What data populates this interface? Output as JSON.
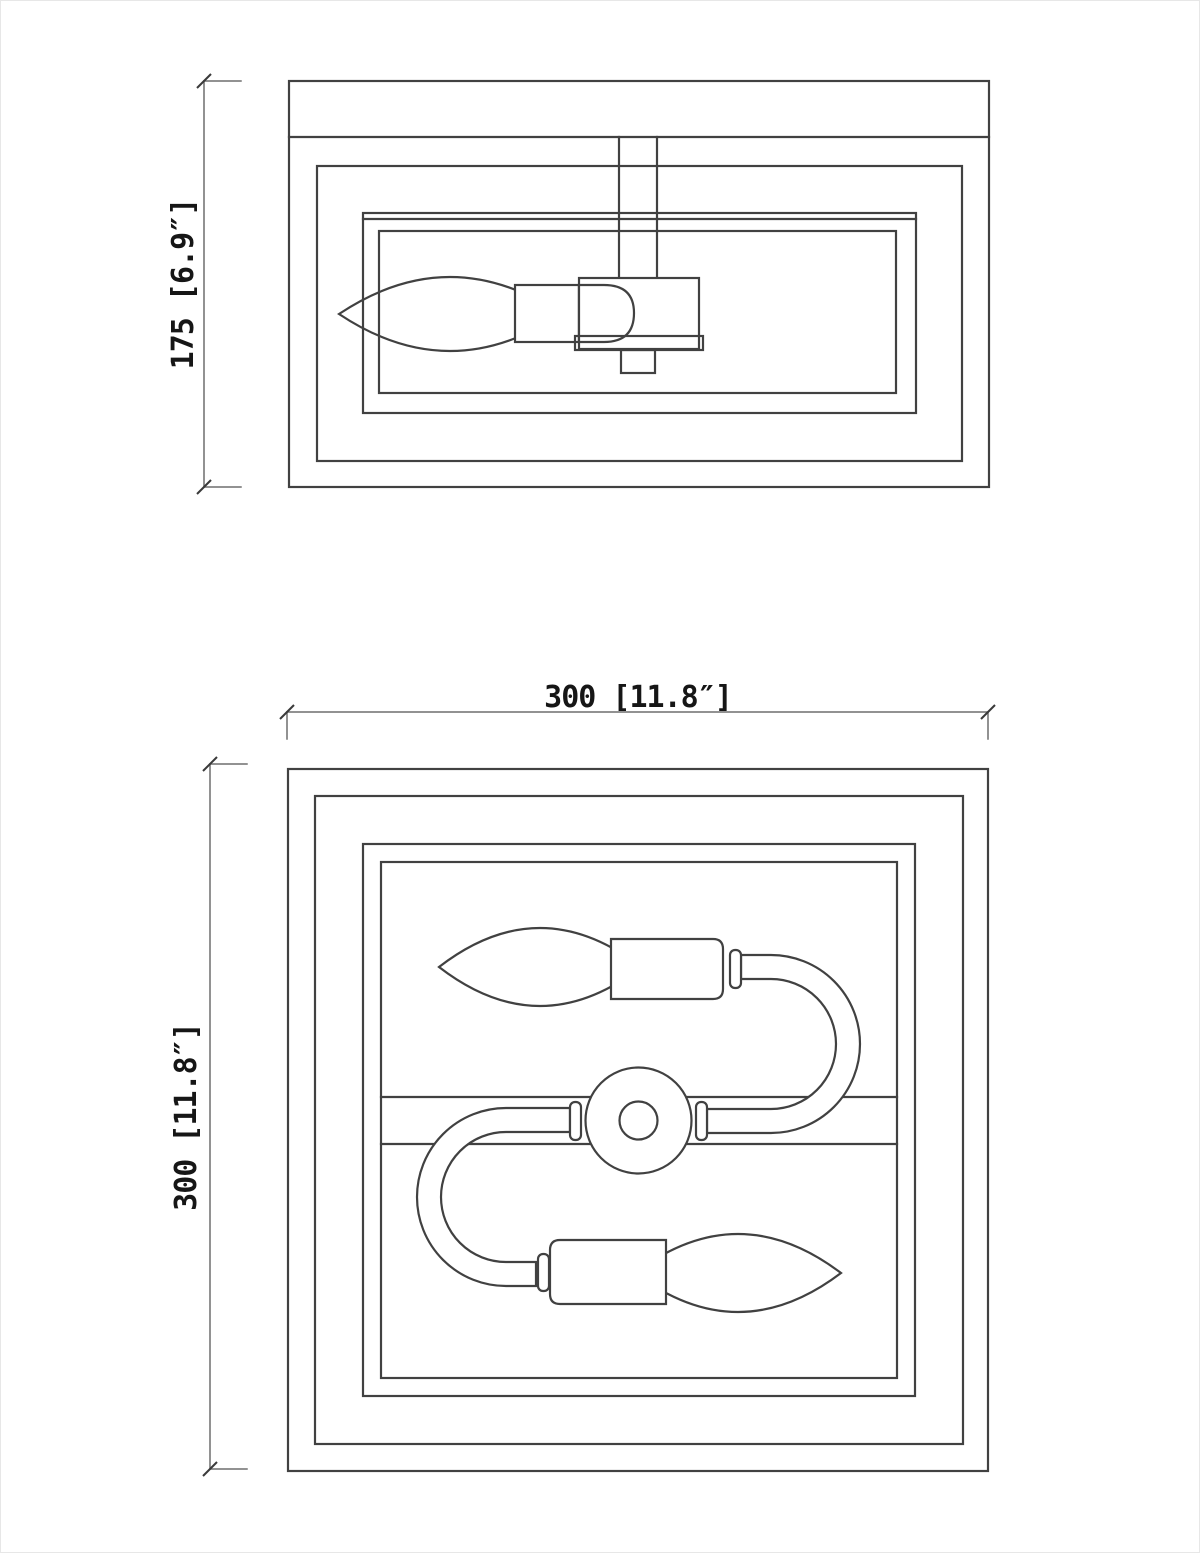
{
  "document": {
    "background_color": "#ffffff",
    "line_color": "#414141",
    "dimension_line_color": "#6e6e6e",
    "dimension_text_color": "#161616"
  },
  "views": {
    "side_elevation": {
      "height_dimension": {
        "label": "175 [6.9″]",
        "millimeters": "175",
        "inches": "6.9″"
      }
    },
    "top_plan": {
      "width_dimension": {
        "label": "300 [11.8″]",
        "millimeters": "300",
        "inches": "11.8″"
      },
      "depth_dimension": {
        "label": "300 [11.8″]",
        "millimeters": "300",
        "inches": "11.8″"
      }
    }
  }
}
